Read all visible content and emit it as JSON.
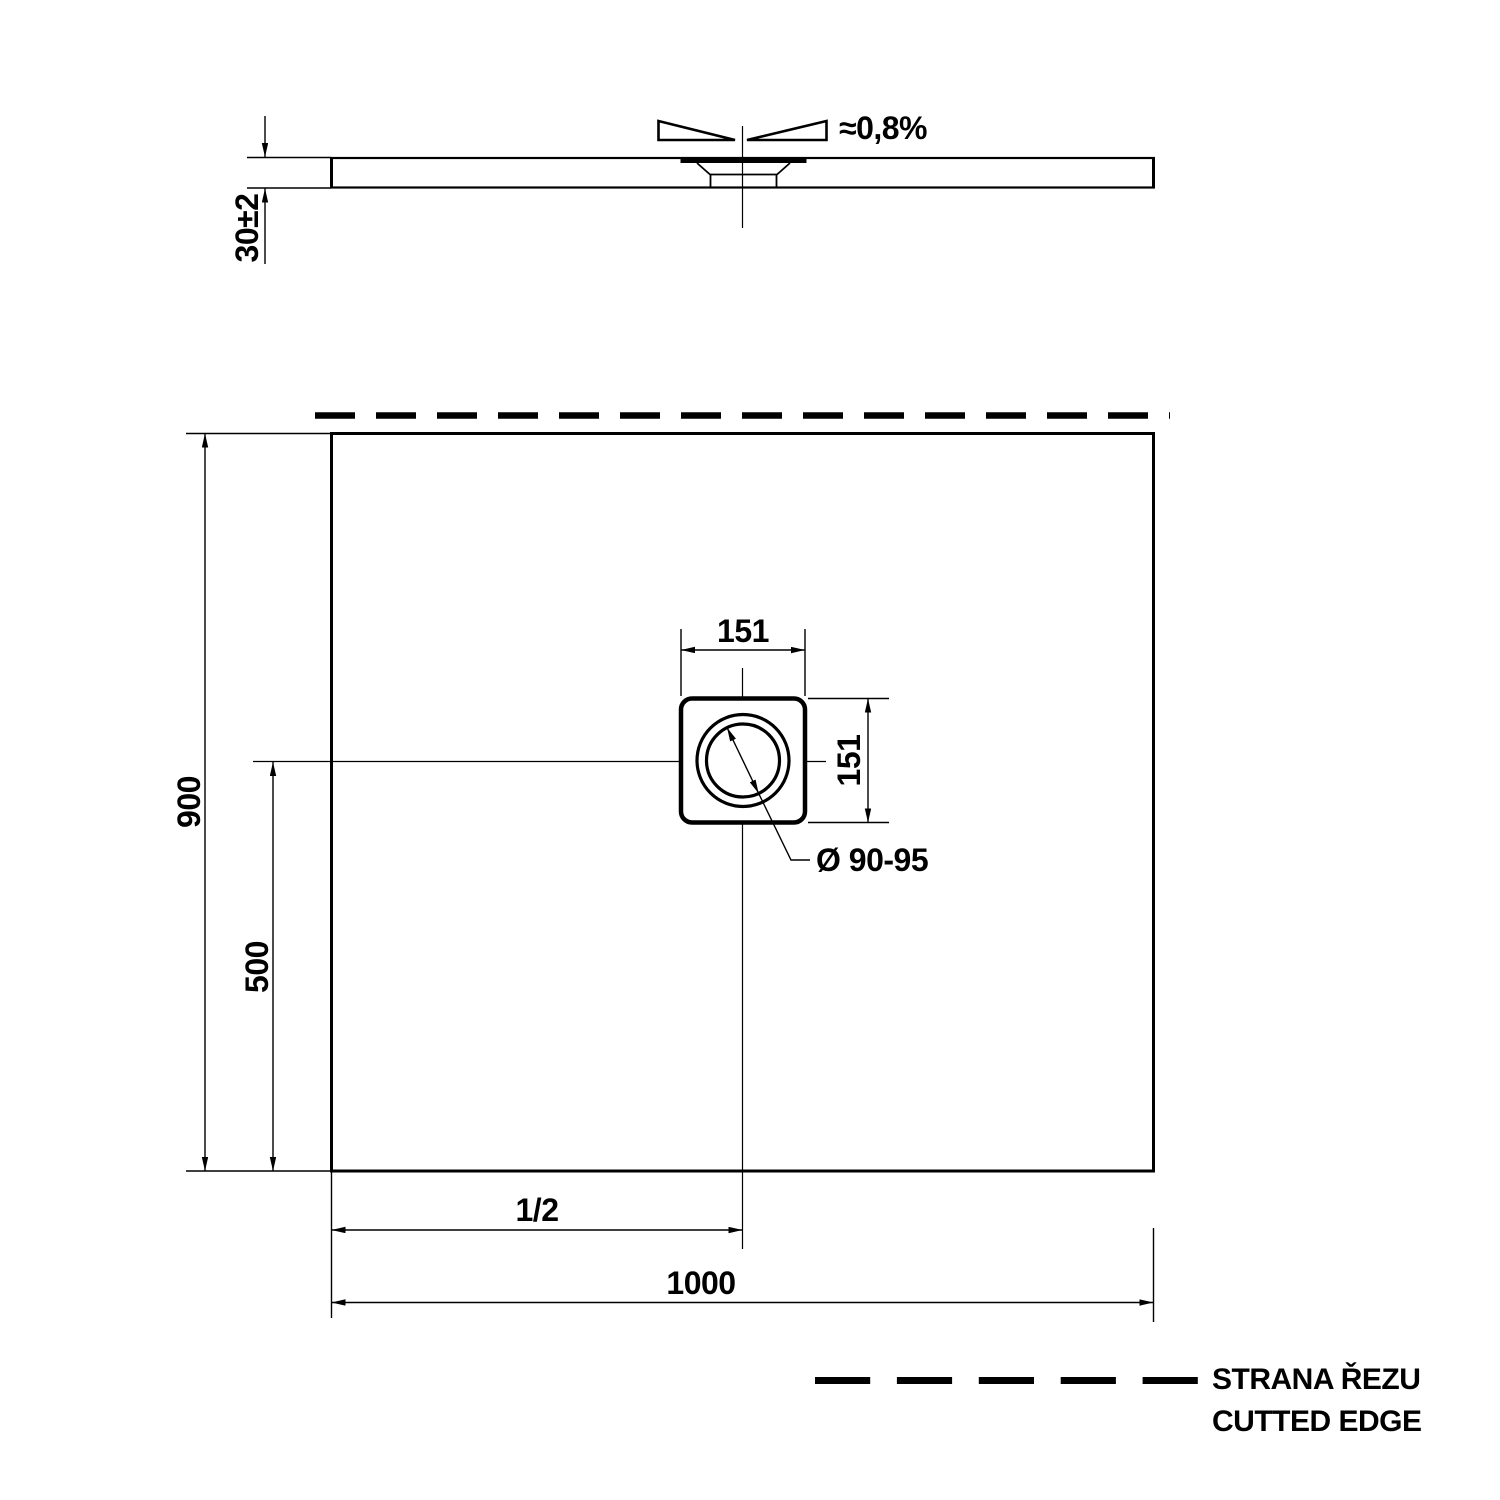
{
  "drawing": {
    "section": {
      "slope_label": "≈0,8%",
      "thickness_label": "30±2"
    },
    "plan": {
      "height_label": "900",
      "drain_offset_label": "500",
      "drain_size_top_label": "151",
      "drain_size_right_label": "151",
      "drain_diameter_label": "Ø 90-95",
      "half_label": "1/2",
      "width_label": "1000"
    },
    "legend": {
      "line1": "STRANA ŘEZU",
      "line2": "CUTTED EDGE"
    },
    "colors": {
      "ink": "#000000",
      "paper": "#ffffff"
    }
  }
}
